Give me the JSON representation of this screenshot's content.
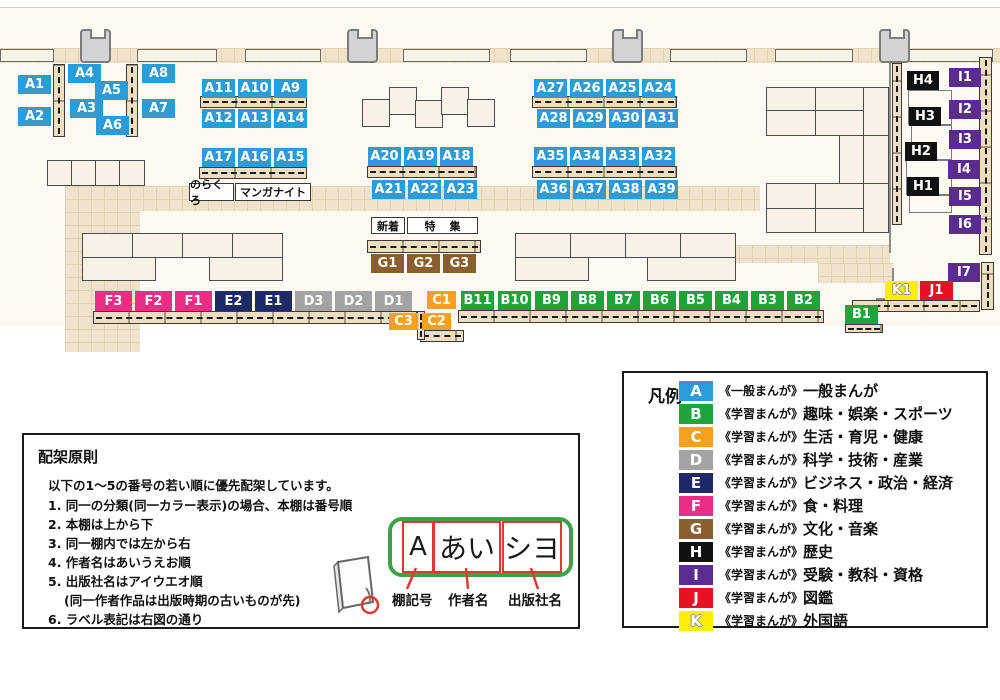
{
  "colors": {
    "A": "#2b9cd8",
    "B": "#1da53c",
    "C": "#f6a01e",
    "D": "#a3a3a3",
    "E": "#1e2a68",
    "F": "#eb2d85",
    "G": "#8b5e2f",
    "H": "#111111",
    "I": "#5b2c90",
    "J": "#e81123",
    "K": "#fcf000"
  },
  "map": {
    "shelves": [
      {
        "id": "A1",
        "cat": "A",
        "x": 18,
        "y": 75
      },
      {
        "id": "A2",
        "cat": "A",
        "x": 18,
        "y": 107
      },
      {
        "id": "A4",
        "cat": "A",
        "x": 68,
        "y": 64
      },
      {
        "id": "A5",
        "cat": "A",
        "x": 95,
        "y": 81
      },
      {
        "id": "A3",
        "cat": "A",
        "x": 70,
        "y": 99
      },
      {
        "id": "A6",
        "cat": "A",
        "x": 96,
        "y": 116
      },
      {
        "id": "A8",
        "cat": "A",
        "x": 142,
        "y": 64
      },
      {
        "id": "A7",
        "cat": "A",
        "x": 142,
        "y": 99
      },
      {
        "id": "A11",
        "cat": "A",
        "x": 202,
        "y": 79
      },
      {
        "id": "A10",
        "cat": "A",
        "x": 238,
        "y": 79
      },
      {
        "id": "A9",
        "cat": "A",
        "x": 274,
        "y": 79
      },
      {
        "id": "A12",
        "cat": "A",
        "x": 202,
        "y": 109
      },
      {
        "id": "A13",
        "cat": "A",
        "x": 238,
        "y": 109
      },
      {
        "id": "A14",
        "cat": "A",
        "x": 274,
        "y": 109
      },
      {
        "id": "A17",
        "cat": "A",
        "x": 202,
        "y": 148
      },
      {
        "id": "A16",
        "cat": "A",
        "x": 238,
        "y": 148
      },
      {
        "id": "A15",
        "cat": "A",
        "x": 274,
        "y": 148
      },
      {
        "id": "A20",
        "cat": "A",
        "x": 368,
        "y": 147
      },
      {
        "id": "A19",
        "cat": "A",
        "x": 404,
        "y": 147
      },
      {
        "id": "A18",
        "cat": "A",
        "x": 440,
        "y": 147
      },
      {
        "id": "A21",
        "cat": "A",
        "x": 372,
        "y": 180
      },
      {
        "id": "A22",
        "cat": "A",
        "x": 408,
        "y": 180
      },
      {
        "id": "A23",
        "cat": "A",
        "x": 444,
        "y": 180
      },
      {
        "id": "A27",
        "cat": "A",
        "x": 534,
        "y": 79
      },
      {
        "id": "A26",
        "cat": "A",
        "x": 570,
        "y": 79
      },
      {
        "id": "A25",
        "cat": "A",
        "x": 606,
        "y": 79
      },
      {
        "id": "A24",
        "cat": "A",
        "x": 642,
        "y": 79
      },
      {
        "id": "A28",
        "cat": "A",
        "x": 537,
        "y": 109
      },
      {
        "id": "A29",
        "cat": "A",
        "x": 573,
        "y": 109
      },
      {
        "id": "A30",
        "cat": "A",
        "x": 609,
        "y": 109
      },
      {
        "id": "A31",
        "cat": "A",
        "x": 645,
        "y": 109
      },
      {
        "id": "A35",
        "cat": "A",
        "x": 534,
        "y": 147
      },
      {
        "id": "A34",
        "cat": "A",
        "x": 570,
        "y": 147
      },
      {
        "id": "A33",
        "cat": "A",
        "x": 606,
        "y": 147
      },
      {
        "id": "A32",
        "cat": "A",
        "x": 642,
        "y": 147
      },
      {
        "id": "A36",
        "cat": "A",
        "x": 537,
        "y": 180
      },
      {
        "id": "A37",
        "cat": "A",
        "x": 573,
        "y": 180
      },
      {
        "id": "A38",
        "cat": "A",
        "x": 609,
        "y": 180
      },
      {
        "id": "A39",
        "cat": "A",
        "x": 645,
        "y": 180
      },
      {
        "id": "G1",
        "cat": "G",
        "x": 371,
        "y": 254
      },
      {
        "id": "G2",
        "cat": "G",
        "x": 407,
        "y": 254
      },
      {
        "id": "G3",
        "cat": "G",
        "x": 443,
        "y": 254
      },
      {
        "id": "F3",
        "cat": "F",
        "x": 95,
        "y": 291,
        "w": 37,
        "h": 20
      },
      {
        "id": "F2",
        "cat": "F",
        "x": 135,
        "y": 291,
        "w": 37,
        "h": 20
      },
      {
        "id": "F1",
        "cat": "F",
        "x": 175,
        "y": 291,
        "w": 37,
        "h": 20
      },
      {
        "id": "E2",
        "cat": "E",
        "x": 215,
        "y": 291,
        "w": 37,
        "h": 20
      },
      {
        "id": "E1",
        "cat": "E",
        "x": 255,
        "y": 291,
        "w": 37,
        "h": 20
      },
      {
        "id": "D3",
        "cat": "D",
        "x": 295,
        "y": 291,
        "w": 37,
        "h": 20
      },
      {
        "id": "D2",
        "cat": "D",
        "x": 335,
        "y": 291,
        "w": 37,
        "h": 20
      },
      {
        "id": "D1",
        "cat": "D",
        "x": 375,
        "y": 291,
        "w": 37,
        "h": 20
      },
      {
        "id": "C1",
        "cat": "C",
        "x": 427,
        "y": 291,
        "w": 29,
        "h": 18
      },
      {
        "id": "C3",
        "cat": "C",
        "x": 389,
        "y": 313,
        "w": 29,
        "h": 17
      },
      {
        "id": "C2",
        "cat": "C",
        "x": 422,
        "y": 313,
        "w": 29,
        "h": 17
      },
      {
        "id": "B11",
        "cat": "B",
        "x": 461,
        "y": 291
      },
      {
        "id": "B10",
        "cat": "B",
        "x": 498,
        "y": 291
      },
      {
        "id": "B9",
        "cat": "B",
        "x": 535,
        "y": 291
      },
      {
        "id": "B8",
        "cat": "B",
        "x": 571,
        "y": 291
      },
      {
        "id": "B7",
        "cat": "B",
        "x": 607,
        "y": 291
      },
      {
        "id": "B6",
        "cat": "B",
        "x": 643,
        "y": 291
      },
      {
        "id": "B5",
        "cat": "B",
        "x": 679,
        "y": 291
      },
      {
        "id": "B4",
        "cat": "B",
        "x": 715,
        "y": 291
      },
      {
        "id": "B3",
        "cat": "B",
        "x": 751,
        "y": 291
      },
      {
        "id": "B2",
        "cat": "B",
        "x": 787,
        "y": 291
      },
      {
        "id": "B1",
        "cat": "B",
        "x": 845,
        "y": 305
      },
      {
        "id": "H4",
        "cat": "H",
        "x": 907,
        "y": 71,
        "w": 32
      },
      {
        "id": "H3",
        "cat": "H",
        "x": 909,
        "y": 107,
        "w": 32
      },
      {
        "id": "H2",
        "cat": "H",
        "x": 905,
        "y": 142,
        "w": 32
      },
      {
        "id": "H1",
        "cat": "H",
        "x": 907,
        "y": 177,
        "w": 32
      },
      {
        "id": "I1",
        "cat": "I",
        "x": 949,
        "y": 68,
        "w": 32
      },
      {
        "id": "I2",
        "cat": "I",
        "x": 949,
        "y": 100,
        "w": 32
      },
      {
        "id": "I3",
        "cat": "I",
        "x": 949,
        "y": 130,
        "w": 32
      },
      {
        "id": "I4",
        "cat": "I",
        "x": 948,
        "y": 160,
        "w": 32
      },
      {
        "id": "I5",
        "cat": "I",
        "x": 949,
        "y": 187,
        "w": 32
      },
      {
        "id": "I6",
        "cat": "I",
        "x": 949,
        "y": 215,
        "w": 32
      },
      {
        "id": "I7",
        "cat": "I",
        "x": 948,
        "y": 263,
        "w": 32
      },
      {
        "id": "K1",
        "cat": "K",
        "x": 885,
        "y": 281
      },
      {
        "id": "J1",
        "cat": "J",
        "x": 920,
        "y": 281
      }
    ],
    "notes": [
      {
        "id": "norakuro",
        "text": "のらくろ",
        "x": 189,
        "y": 183,
        "w": 45,
        "h": 18
      },
      {
        "id": "manga-night",
        "text": "マンガナイト",
        "x": 235,
        "y": 183,
        "w": 76,
        "h": 18
      },
      {
        "id": "shinchaku",
        "text": "新着",
        "x": 371,
        "y": 217,
        "w": 34,
        "h": 17
      },
      {
        "id": "tokushu",
        "text": "特集",
        "x": 407,
        "y": 217,
        "w": 71,
        "h": 17
      }
    ]
  },
  "legend": {
    "title": "凡例",
    "rows": [
      {
        "letter": "A",
        "type": "《一般まんが》",
        "category": "一般まんが"
      },
      {
        "letter": "B",
        "type": "《学習まんが》",
        "category": "趣味・娯楽・スポーツ"
      },
      {
        "letter": "C",
        "type": "《学習まんが》",
        "category": "生活・育児・健康"
      },
      {
        "letter": "D",
        "type": "《学習まんが》",
        "category": "科学・技術・産業"
      },
      {
        "letter": "E",
        "type": "《学習まんが》",
        "category": "ビジネス・政治・経済"
      },
      {
        "letter": "F",
        "type": "《学習まんが》",
        "category": "食・料理"
      },
      {
        "letter": "G",
        "type": "《学習まんが》",
        "category": "文化・音楽"
      },
      {
        "letter": "H",
        "type": "《学習まんが》",
        "category": "歴史"
      },
      {
        "letter": "I",
        "type": "《学習まんが》",
        "category": "受験・教科・資格"
      },
      {
        "letter": "J",
        "type": "《学習まんが》",
        "category": "図鑑"
      },
      {
        "letter": "K",
        "type": "《学習まんが》",
        "category": "外国語"
      }
    ]
  },
  "principles": {
    "title": "配架原則",
    "intro": "以下の1〜5の番号の若い順に優先配架しています。",
    "items": [
      {
        "text": "1. 同一の分類(同一カラー表示)の場合、本棚は番号順"
      },
      {
        "text": "2. 本棚は上から下"
      },
      {
        "text": "3. 同一棚内では左から右"
      },
      {
        "text": "4. 作者名はあいうえお順"
      },
      {
        "text": "5. 出版社名はアイウエオ順"
      },
      {
        "text": "(同一作者作品は出版時期の古いものが先)",
        "indent": true
      },
      {
        "text": "6. ラベル表記は右図の通り"
      }
    ],
    "label_example": {
      "shelf_code": "A",
      "author": "あい",
      "publisher": "シヨ"
    },
    "captions": {
      "shelf_code": "棚記号",
      "author": "作者名",
      "publisher": "出版社名"
    }
  }
}
